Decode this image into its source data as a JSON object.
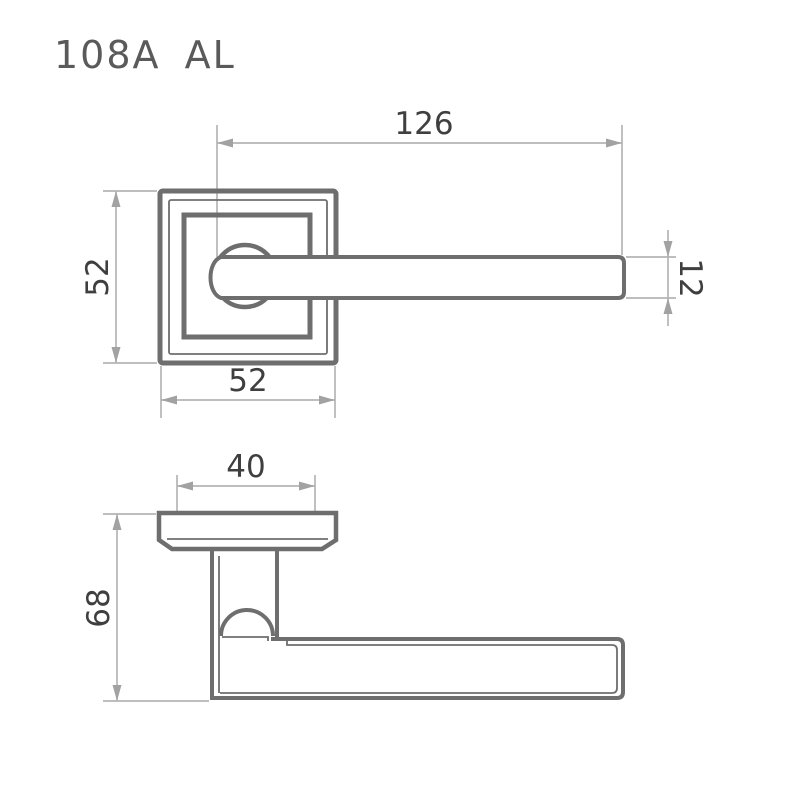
{
  "title": "108A AL",
  "front_view": {
    "dim_handle_length": "126",
    "dim_rose_height": "52",
    "dim_rose_width": "52",
    "dim_lever_thickness": "12"
  },
  "side_view": {
    "dim_rose_face_width": "40",
    "dim_overall_depth": "68"
  },
  "colors": {
    "object_line": "#6e6e6e",
    "dimension_line": "#b5b5b5",
    "arrowhead": "#a2a2a2",
    "dimension_text": "#3f3f3f",
    "title_text": "#5a5a5a",
    "background": "#ffffff"
  }
}
